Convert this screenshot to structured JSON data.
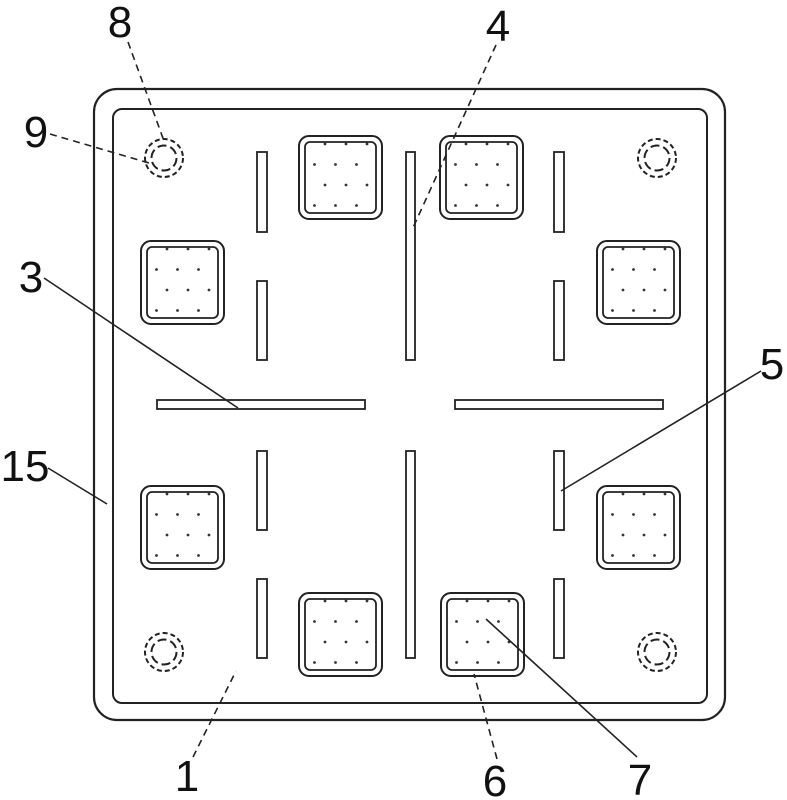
{
  "drawing": {
    "kind": "patent-style plan view of a square plate",
    "colors": {
      "line": "#222222",
      "background": "#ffffff",
      "text": "#111111"
    },
    "labels": {
      "l1": "1",
      "l3": "3",
      "l4": "4",
      "l5": "5",
      "l6": "6",
      "l7": "7",
      "l8": "8",
      "l9": "9",
      "l15": "15"
    }
  }
}
